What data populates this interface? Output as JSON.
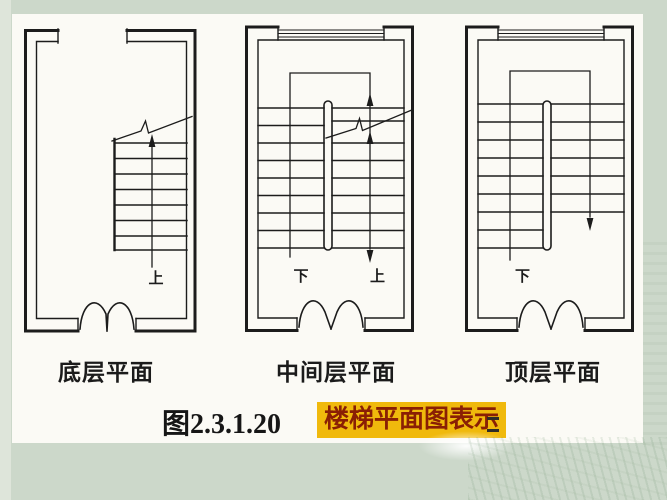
{
  "slide": {
    "background_color": "#ccd8ca",
    "panel_color": "#fbfaf5",
    "ink_color": "#1c1c1c"
  },
  "plans": [
    {
      "label": "底层平面",
      "direction_labels": [
        {
          "text": "上"
        }
      ]
    },
    {
      "label": "中间层平面",
      "direction_labels": [
        {
          "text": "下"
        },
        {
          "text": "上"
        }
      ]
    },
    {
      "label": "顶层平面",
      "direction_labels": [
        {
          "text": "下"
        }
      ]
    }
  ],
  "caption": {
    "figure_number": "图2.3.1.20",
    "highlight_text": "楼梯平面图表示",
    "highlight_background": "#f0b90c",
    "highlight_text_color": "#8a1f04"
  }
}
